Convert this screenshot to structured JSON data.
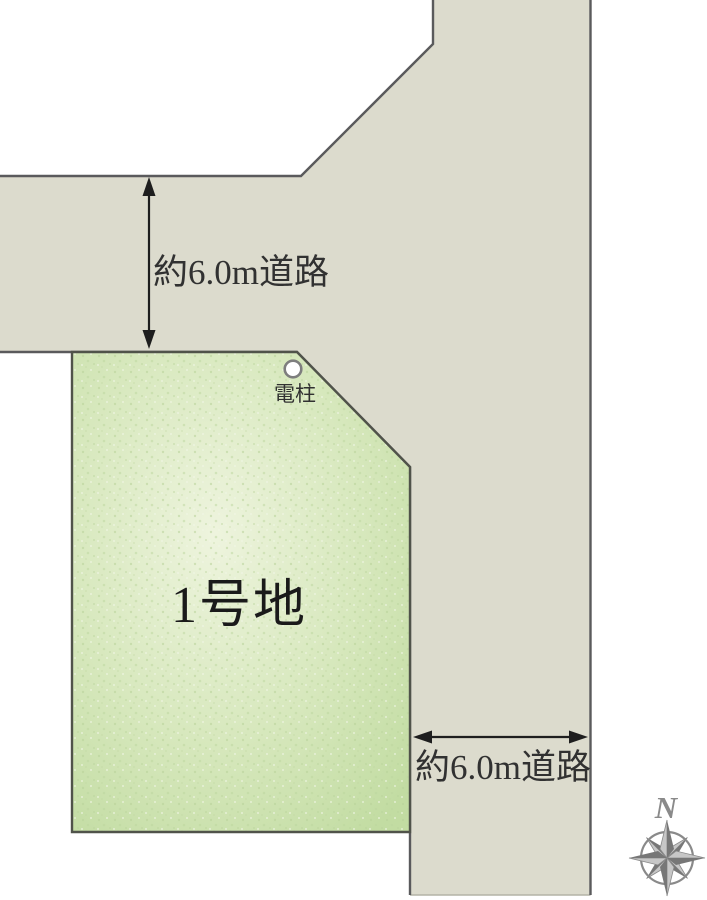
{
  "roads": {
    "top": {
      "width_label": "約6.0m道路"
    },
    "right": {
      "width_label": "約6.0m道路"
    }
  },
  "lot": {
    "name": "1号地"
  },
  "pole": {
    "label": "電柱"
  },
  "compass": {
    "north_label": "N"
  },
  "colors": {
    "background": "#ffffff",
    "road_fill": "#dcdbcd",
    "road_stroke": "#5a5a5c",
    "road_bottom_edge": "#b4b3a6",
    "lot_fill_center": "#eef4de",
    "lot_fill_mid": "#d7e8bd",
    "lot_fill_edge": "#c2dca2",
    "lot_stroke": "#50534a",
    "arrow": "#1e1e1e",
    "label_text": "#313131",
    "lot_text": "#1a1a1a",
    "pole_circle_stroke": "#7e7e7e",
    "compass_gray": "#8a8a8a",
    "compass_dark": "#777777",
    "compass_light": "#c7c7c7"
  }
}
